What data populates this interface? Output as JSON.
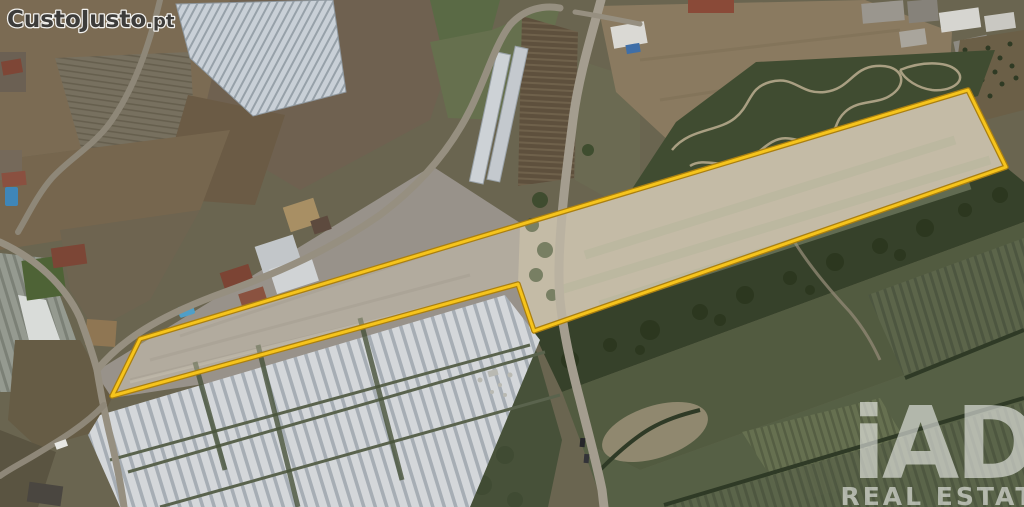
{
  "watermark": {
    "brand": "CustoJusto",
    "tld": ".pt"
  },
  "brand_logo": {
    "name": "iAD",
    "tagline": "REAL ESTATE"
  },
  "parcel": {
    "points": "112,396 140,339 968,90 1006,167 534,331 518,284",
    "outline_color": "#f6c41c",
    "outline_edge_color": "#aa7f10",
    "fill": "rgba(240,230,206,0.30)"
  },
  "colors": {
    "watermark_fill": "#3d3c3a",
    "watermark_outline": "#f2f1ee",
    "logo_white": "rgba(255,255,255,0.55)"
  }
}
